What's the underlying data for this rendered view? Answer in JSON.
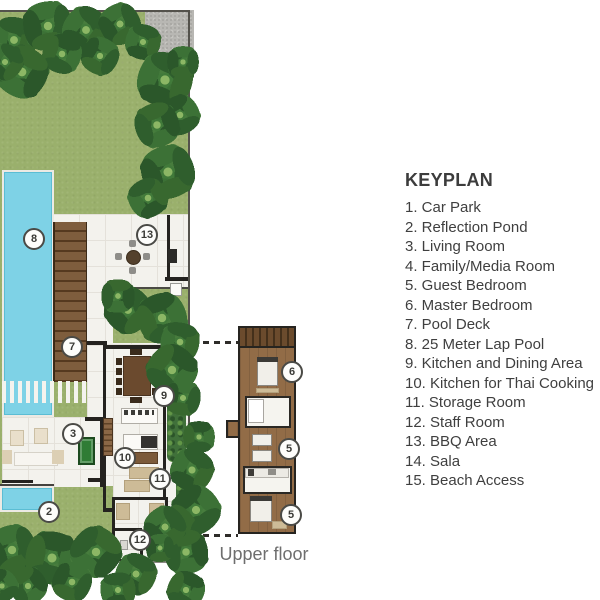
{
  "legend": {
    "title": "KEYPLAN",
    "items": [
      "1. Car Park",
      "2. Reflection Pond",
      "3. Living Room",
      "4. Family/Media Room",
      "5. Guest Bedroom",
      "6. Master Bedroom",
      "7. Pool Deck",
      "8. 25 Meter Lap Pool",
      "9. Kitchen and Dining Area",
      "10. Kitchen for Thai Cooking",
      "11. Storage Room",
      "12. Staff Room",
      "13. BBQ Area",
      "14. Sala",
      "15. Beach Access"
    ]
  },
  "upper_floor_label": "Upper floor",
  "markers": [
    {
      "label": "8",
      "x": 34,
      "y": 239
    },
    {
      "label": "13",
      "x": 147,
      "y": 235
    },
    {
      "label": "7",
      "x": 72,
      "y": 347
    },
    {
      "label": "9",
      "x": 164,
      "y": 396
    },
    {
      "label": "3",
      "x": 73,
      "y": 434
    },
    {
      "label": "10",
      "x": 125,
      "y": 458
    },
    {
      "label": "11",
      "x": 160,
      "y": 479
    },
    {
      "label": "2",
      "x": 49,
      "y": 512
    },
    {
      "label": "12",
      "x": 140,
      "y": 540
    },
    {
      "label": "6",
      "x": 292,
      "y": 372
    },
    {
      "label": "5",
      "x": 289,
      "y": 449
    },
    {
      "label": "5",
      "x": 291,
      "y": 515
    }
  ],
  "colors": {
    "lawn": "#9ab06c",
    "pool": "#7ed2e6",
    "deck_wood": "#7b5a3a",
    "upper_wood": "#926c47",
    "wall": "#24221f",
    "floor": "#f3f2ed",
    "grid": "#e4e1da",
    "concrete": "#b8b7b3",
    "tan": "#cdbb97",
    "text": "#3f3f3f",
    "muted": "#6e6e6e"
  }
}
